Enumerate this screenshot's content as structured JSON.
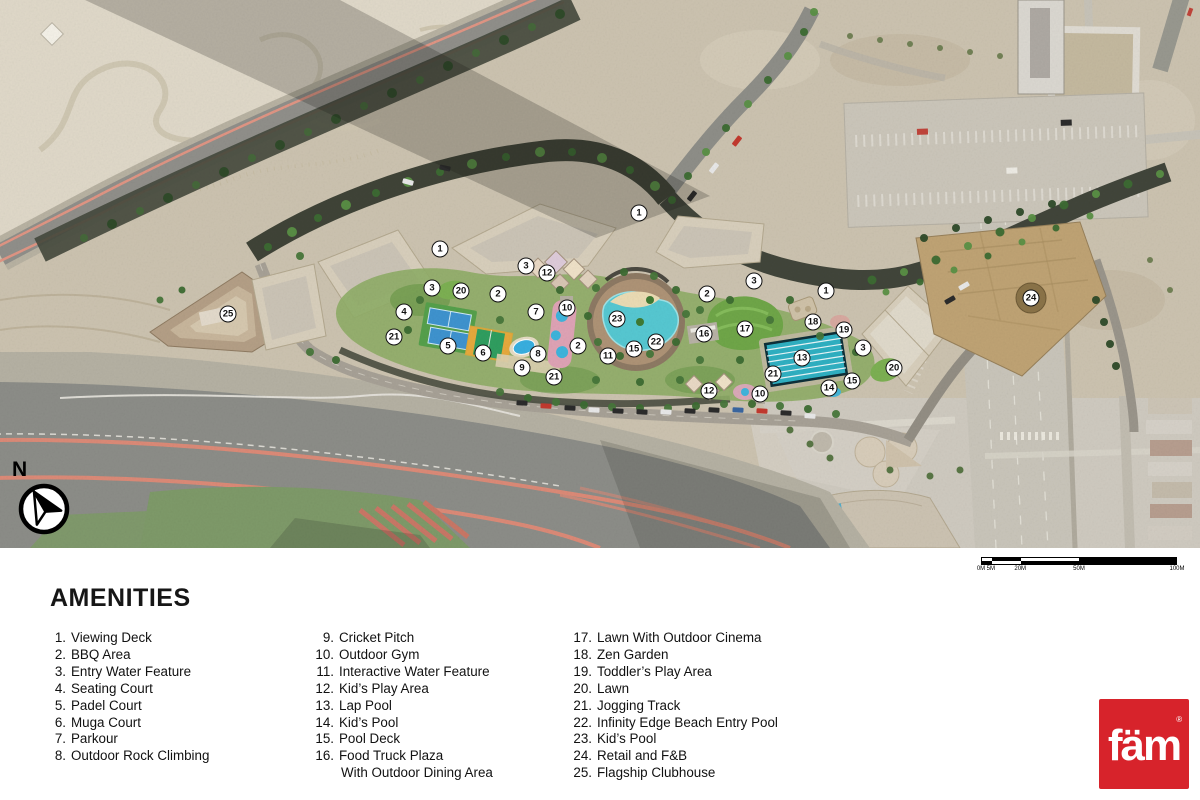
{
  "legend": {
    "title": "AMENITIES",
    "columns": [
      [
        {
          "num": "1.",
          "label": "Viewing Deck"
        },
        {
          "num": "2.",
          "label": "BBQ Area"
        },
        {
          "num": "3.",
          "label": "Entry Water Feature"
        },
        {
          "num": "4.",
          "label": "Seating Court"
        },
        {
          "num": "5.",
          "label": "Padel Court"
        },
        {
          "num": "6.",
          "label": "Muga Court"
        },
        {
          "num": "7.",
          "label": "Parkour"
        },
        {
          "num": "8.",
          "label": "Outdoor Rock Climbing"
        }
      ],
      [
        {
          "num": "9.",
          "label": "Cricket Pitch"
        },
        {
          "num": "10.",
          "label": "Outdoor Gym"
        },
        {
          "num": "11.",
          "label": "Interactive Water Feature"
        },
        {
          "num": "12.",
          "label": "Kid’s Play Area"
        },
        {
          "num": "13.",
          "label": "Lap Pool"
        },
        {
          "num": "14.",
          "label": "Kid’s Pool"
        },
        {
          "num": "15.",
          "label": "Pool Deck"
        },
        {
          "num": "16.",
          "label": "Food Truck Plaza",
          "label2": "With Outdoor Dining Area"
        }
      ],
      [
        {
          "num": "17.",
          "label": "Lawn With Outdoor Cinema"
        },
        {
          "num": "18.",
          "label": "Zen Garden"
        },
        {
          "num": "19.",
          "label": "Toddler’s Play Area"
        },
        {
          "num": "20.",
          "label": "Lawn"
        },
        {
          "num": "21.",
          "label": "Jogging Track"
        },
        {
          "num": "22.",
          "label": "Infinity Edge Beach Entry Pool"
        },
        {
          "num": "23.",
          "label": "Kid’s Pool"
        },
        {
          "num": "24.",
          "label": "Retail and F&B"
        },
        {
          "num": "25.",
          "label": "Flagship Clubhouse"
        }
      ]
    ]
  },
  "map": {
    "north_label": "N",
    "scale_bar": {
      "labels": [
        "0M",
        "5M",
        "20M",
        "50M",
        "100M"
      ],
      "positions_pct": [
        0,
        5,
        20,
        50,
        100
      ]
    },
    "markers": [
      {
        "n": "1",
        "x": 440,
        "y": 249
      },
      {
        "n": "1",
        "x": 639,
        "y": 213
      },
      {
        "n": "1",
        "x": 826,
        "y": 291
      },
      {
        "n": "2",
        "x": 498,
        "y": 294
      },
      {
        "n": "2",
        "x": 578,
        "y": 346
      },
      {
        "n": "2",
        "x": 707,
        "y": 294
      },
      {
        "n": "3",
        "x": 432,
        "y": 288
      },
      {
        "n": "3",
        "x": 526,
        "y": 266
      },
      {
        "n": "3",
        "x": 754,
        "y": 281
      },
      {
        "n": "3",
        "x": 863,
        "y": 348
      },
      {
        "n": "4",
        "x": 404,
        "y": 312
      },
      {
        "n": "5",
        "x": 448,
        "y": 346
      },
      {
        "n": "6",
        "x": 483,
        "y": 353
      },
      {
        "n": "7",
        "x": 536,
        "y": 312
      },
      {
        "n": "8",
        "x": 538,
        "y": 354
      },
      {
        "n": "9",
        "x": 522,
        "y": 368
      },
      {
        "n": "10",
        "x": 567,
        "y": 308
      },
      {
        "n": "10",
        "x": 760,
        "y": 394
      },
      {
        "n": "11",
        "x": 608,
        "y": 356
      },
      {
        "n": "12",
        "x": 547,
        "y": 273
      },
      {
        "n": "12",
        "x": 709,
        "y": 391
      },
      {
        "n": "13",
        "x": 802,
        "y": 358
      },
      {
        "n": "14",
        "x": 829,
        "y": 388
      },
      {
        "n": "15",
        "x": 634,
        "y": 349
      },
      {
        "n": "15",
        "x": 852,
        "y": 381
      },
      {
        "n": "16",
        "x": 704,
        "y": 334
      },
      {
        "n": "17",
        "x": 745,
        "y": 329
      },
      {
        "n": "18",
        "x": 813,
        "y": 322
      },
      {
        "n": "19",
        "x": 844,
        "y": 330
      },
      {
        "n": "20",
        "x": 461,
        "y": 291
      },
      {
        "n": "20",
        "x": 894,
        "y": 368
      },
      {
        "n": "21",
        "x": 394,
        "y": 337
      },
      {
        "n": "21",
        "x": 554,
        "y": 377
      },
      {
        "n": "21",
        "x": 773,
        "y": 374
      },
      {
        "n": "22",
        "x": 656,
        "y": 342
      },
      {
        "n": "23",
        "x": 617,
        "y": 319
      },
      {
        "n": "24",
        "x": 1031,
        "y": 298
      },
      {
        "n": "25",
        "x": 228,
        "y": 314
      }
    ]
  },
  "logo": {
    "text": "fäm",
    "registered": "®",
    "color": "#D7232B"
  },
  "colors": {
    "desert": "#CCC3B0",
    "pale_desert": "#E0D9C9",
    "asphalt": "#8C8D88",
    "curb_pink": "#DC8A77",
    "site_tree_band": "#3F4337",
    "lawn_green": "#74A84A",
    "pool_teal": "#56C8D2",
    "lap_pool": "#2FB0C2",
    "gold_building": "#BFA374",
    "building_beige": "#D8CFBC",
    "marker_bg": "#FFFFFF",
    "marker_border": "#111111"
  }
}
